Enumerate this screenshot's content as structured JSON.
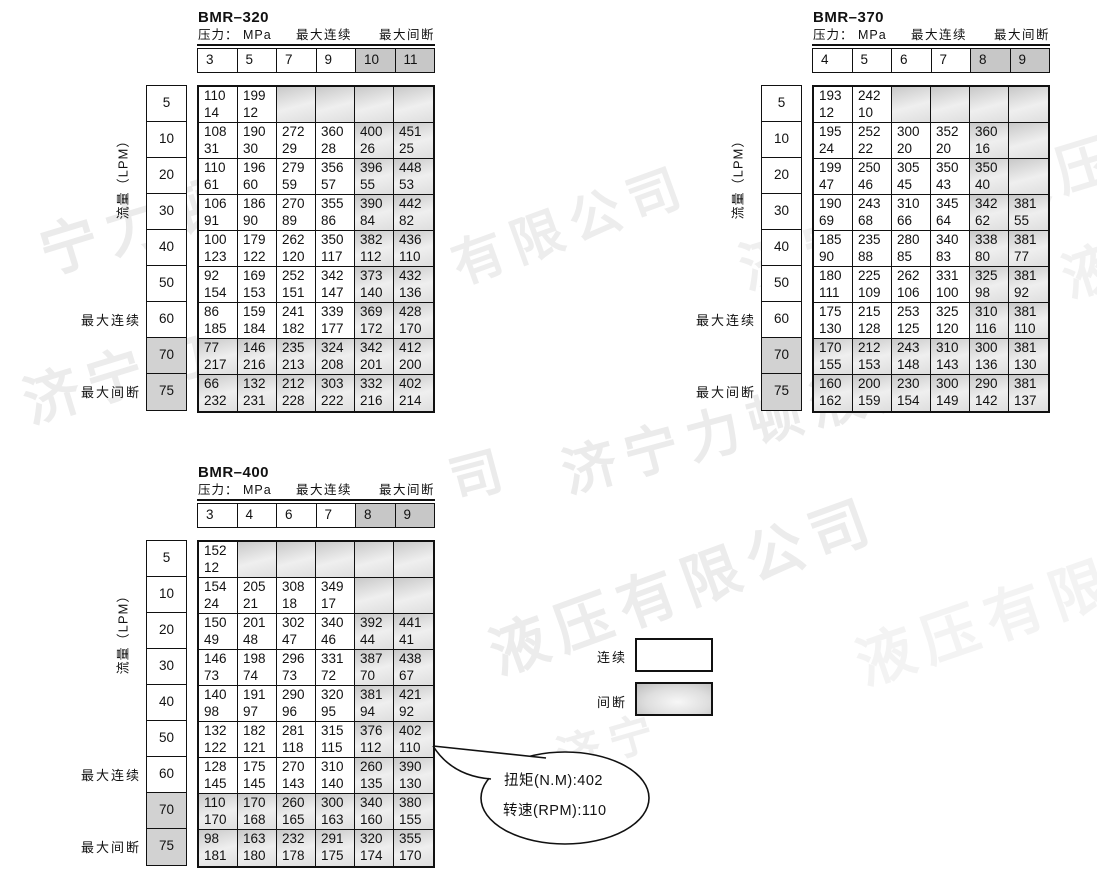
{
  "legend": {
    "continuous_label": "连续",
    "intermittent_label": "间断"
  },
  "callout": {
    "line1": "扭矩(N.M):402",
    "line2": "转速(RPM):110"
  },
  "colors": {
    "header_shade": "#c7c7c7",
    "flow_shade": "#d2d2d2",
    "cell_shade_dark": "#c8c8c8",
    "cell_shade_light": "#efefef",
    "border": "#111111",
    "watermark": "#ececec"
  },
  "tables": [
    {
      "title": "BMR–320",
      "pressure_label": "压力： MPa",
      "max_continuous_label": "最大连续",
      "max_intermittent_label": "最大间断",
      "flow_axis_label": "流量（LPM）",
      "side_max_continuous": "最大连续",
      "side_max_intermittent": "最大间断",
      "pressures": [
        "3",
        "5",
        "7",
        "9",
        "10",
        "11"
      ],
      "flows": [
        "5",
        "10",
        "20",
        "30",
        "40",
        "50",
        "60",
        "70",
        "75"
      ],
      "rows": [
        [
          [
            "110",
            "14"
          ],
          [
            "199",
            "12"
          ],
          null,
          null,
          null,
          null
        ],
        [
          [
            "108",
            "31"
          ],
          [
            "190",
            "30"
          ],
          [
            "272",
            "29"
          ],
          [
            "360",
            "28"
          ],
          [
            "400",
            "26"
          ],
          [
            "451",
            "25"
          ]
        ],
        [
          [
            "110",
            "61"
          ],
          [
            "196",
            "60"
          ],
          [
            "279",
            "59"
          ],
          [
            "356",
            "57"
          ],
          [
            "396",
            "55"
          ],
          [
            "448",
            "53"
          ]
        ],
        [
          [
            "106",
            "91"
          ],
          [
            "186",
            "90"
          ],
          [
            "270",
            "89"
          ],
          [
            "355",
            "86"
          ],
          [
            "390",
            "84"
          ],
          [
            "442",
            "82"
          ]
        ],
        [
          [
            "100",
            "123"
          ],
          [
            "179",
            "122"
          ],
          [
            "262",
            "120"
          ],
          [
            "350",
            "117"
          ],
          [
            "382",
            "112"
          ],
          [
            "436",
            "110"
          ]
        ],
        [
          [
            "92",
            "154"
          ],
          [
            "169",
            "153"
          ],
          [
            "252",
            "151"
          ],
          [
            "342",
            "147"
          ],
          [
            "373",
            "140"
          ],
          [
            "432",
            "136"
          ]
        ],
        [
          [
            "86",
            "185"
          ],
          [
            "159",
            "184"
          ],
          [
            "241",
            "182"
          ],
          [
            "339",
            "177"
          ],
          [
            "369",
            "172"
          ],
          [
            "428",
            "170"
          ]
        ],
        [
          [
            "77",
            "217"
          ],
          [
            "146",
            "216"
          ],
          [
            "235",
            "213"
          ],
          [
            "324",
            "208"
          ],
          [
            "342",
            "201"
          ],
          [
            "412",
            "200"
          ]
        ],
        [
          [
            "66",
            "232"
          ],
          [
            "132",
            "231"
          ],
          [
            "212",
            "228"
          ],
          [
            "303",
            "222"
          ],
          [
            "332",
            "216"
          ],
          [
            "402",
            "214"
          ]
        ]
      ]
    },
    {
      "title": "BMR–370",
      "pressure_label": "压力： MPa",
      "max_continuous_label": "最大连续",
      "max_intermittent_label": "最大间断",
      "flow_axis_label": "流量（LPM）",
      "side_max_continuous": "最大连续",
      "side_max_intermittent": "最大间断",
      "pressures": [
        "4",
        "5",
        "6",
        "7",
        "8",
        "9"
      ],
      "flows": [
        "5",
        "10",
        "20",
        "30",
        "40",
        "50",
        "60",
        "70",
        "75"
      ],
      "rows": [
        [
          [
            "193",
            "12"
          ],
          [
            "242",
            "10"
          ],
          null,
          null,
          null,
          null
        ],
        [
          [
            "195",
            "24"
          ],
          [
            "252",
            "22"
          ],
          [
            "300",
            "20"
          ],
          [
            "352",
            "20"
          ],
          [
            "360",
            "16"
          ],
          null
        ],
        [
          [
            "199",
            "47"
          ],
          [
            "250",
            "46"
          ],
          [
            "305",
            "45"
          ],
          [
            "350",
            "43"
          ],
          [
            "350",
            "40"
          ],
          null
        ],
        [
          [
            "190",
            "69"
          ],
          [
            "243",
            "68"
          ],
          [
            "310",
            "66"
          ],
          [
            "345",
            "64"
          ],
          [
            "342",
            "62"
          ],
          [
            "381",
            "55"
          ]
        ],
        [
          [
            "185",
            "90"
          ],
          [
            "235",
            "88"
          ],
          [
            "280",
            "85"
          ],
          [
            "340",
            "83"
          ],
          [
            "338",
            "80"
          ],
          [
            "381",
            "77"
          ]
        ],
        [
          [
            "180",
            "111"
          ],
          [
            "225",
            "109"
          ],
          [
            "262",
            "106"
          ],
          [
            "331",
            "100"
          ],
          [
            "325",
            "98"
          ],
          [
            "381",
            "92"
          ]
        ],
        [
          [
            "175",
            "130"
          ],
          [
            "215",
            "128"
          ],
          [
            "253",
            "125"
          ],
          [
            "325",
            "120"
          ],
          [
            "310",
            "116"
          ],
          [
            "381",
            "110"
          ]
        ],
        [
          [
            "170",
            "155"
          ],
          [
            "212",
            "153"
          ],
          [
            "243",
            "148"
          ],
          [
            "310",
            "143"
          ],
          [
            "300",
            "136"
          ],
          [
            "381",
            "130"
          ]
        ],
        [
          [
            "160",
            "162"
          ],
          [
            "200",
            "159"
          ],
          [
            "230",
            "154"
          ],
          [
            "300",
            "149"
          ],
          [
            "290",
            "142"
          ],
          [
            "381",
            "137"
          ]
        ]
      ]
    },
    {
      "title": "BMR–400",
      "pressure_label": "压力： MPa",
      "max_continuous_label": "最大连续",
      "max_intermittent_label": "最大间断",
      "flow_axis_label": "流量（LPM）",
      "side_max_continuous": "最大连续",
      "side_max_intermittent": "最大间断",
      "pressures": [
        "3",
        "4",
        "6",
        "7",
        "8",
        "9"
      ],
      "flows": [
        "5",
        "10",
        "20",
        "30",
        "40",
        "50",
        "60",
        "70",
        "75"
      ],
      "rows": [
        [
          [
            "152",
            "12"
          ],
          null,
          null,
          null,
          null,
          null
        ],
        [
          [
            "154",
            "24"
          ],
          [
            "205",
            "21"
          ],
          [
            "308",
            "18"
          ],
          [
            "349",
            "17"
          ],
          null,
          null
        ],
        [
          [
            "150",
            "49"
          ],
          [
            "201",
            "48"
          ],
          [
            "302",
            "47"
          ],
          [
            "340",
            "46"
          ],
          [
            "392",
            "44"
          ],
          [
            "441",
            "41"
          ]
        ],
        [
          [
            "146",
            "73"
          ],
          [
            "198",
            "74"
          ],
          [
            "296",
            "73"
          ],
          [
            "331",
            "72"
          ],
          [
            "387",
            "70"
          ],
          [
            "438",
            "67"
          ]
        ],
        [
          [
            "140",
            "98"
          ],
          [
            "191",
            "97"
          ],
          [
            "290",
            "96"
          ],
          [
            "320",
            "95"
          ],
          [
            "381",
            "94"
          ],
          [
            "421",
            "92"
          ]
        ],
        [
          [
            "132",
            "122"
          ],
          [
            "182",
            "121"
          ],
          [
            "281",
            "118"
          ],
          [
            "315",
            "115"
          ],
          [
            "376",
            "112"
          ],
          [
            "402",
            "110"
          ]
        ],
        [
          [
            "128",
            "145"
          ],
          [
            "175",
            "145"
          ],
          [
            "270",
            "143"
          ],
          [
            "310",
            "140"
          ],
          [
            "260",
            "135"
          ],
          [
            "390",
            "130"
          ]
        ],
        [
          [
            "110",
            "170"
          ],
          [
            "170",
            "168"
          ],
          [
            "260",
            "165"
          ],
          [
            "300",
            "163"
          ],
          [
            "340",
            "160"
          ],
          [
            "380",
            "155"
          ]
        ],
        [
          [
            "98",
            "181"
          ],
          [
            "163",
            "180"
          ],
          [
            "232",
            "178"
          ],
          [
            "291",
            "175"
          ],
          [
            "320",
            "174"
          ],
          [
            "355",
            "170"
          ]
        ]
      ]
    }
  ],
  "watermarks": [
    {
      "text": "宁力顿液压限",
      "x": 28,
      "y": 210,
      "rot": -17,
      "size": 58,
      "color": "#ebebeb"
    },
    {
      "text": "有限公司",
      "x": 440,
      "y": 228,
      "rot": -20,
      "size": 52,
      "color": "#ededed"
    },
    {
      "text": "济宁力顿液压",
      "x": 728,
      "y": 228,
      "rot": -17,
      "size": 56,
      "color": "#efefef"
    },
    {
      "text": "济宁力顿",
      "x": 12,
      "y": 362,
      "rot": -17,
      "size": 56,
      "color": "#ececec"
    },
    {
      "text": "司",
      "x": 440,
      "y": 442,
      "rot": -15,
      "size": 52,
      "color": "#ebebeb"
    },
    {
      "text": "济宁力顿液压",
      "x": 552,
      "y": 432,
      "rot": -15,
      "size": 54,
      "color": "#ebebeb"
    },
    {
      "text": "液压有限公司",
      "x": 476,
      "y": 612,
      "rot": -20,
      "size": 58,
      "color": "#ececec"
    },
    {
      "text": "液压有限",
      "x": 843,
      "y": 622,
      "rot": -19,
      "size": 58,
      "color": "#f3f3f3"
    },
    {
      "text": "济宁",
      "x": 548,
      "y": 724,
      "rot": -16,
      "size": 44,
      "color": "#efefef"
    },
    {
      "text": "液",
      "x": 1050,
      "y": 238,
      "rot": -18,
      "size": 54,
      "color": "#f1f1f1"
    }
  ]
}
